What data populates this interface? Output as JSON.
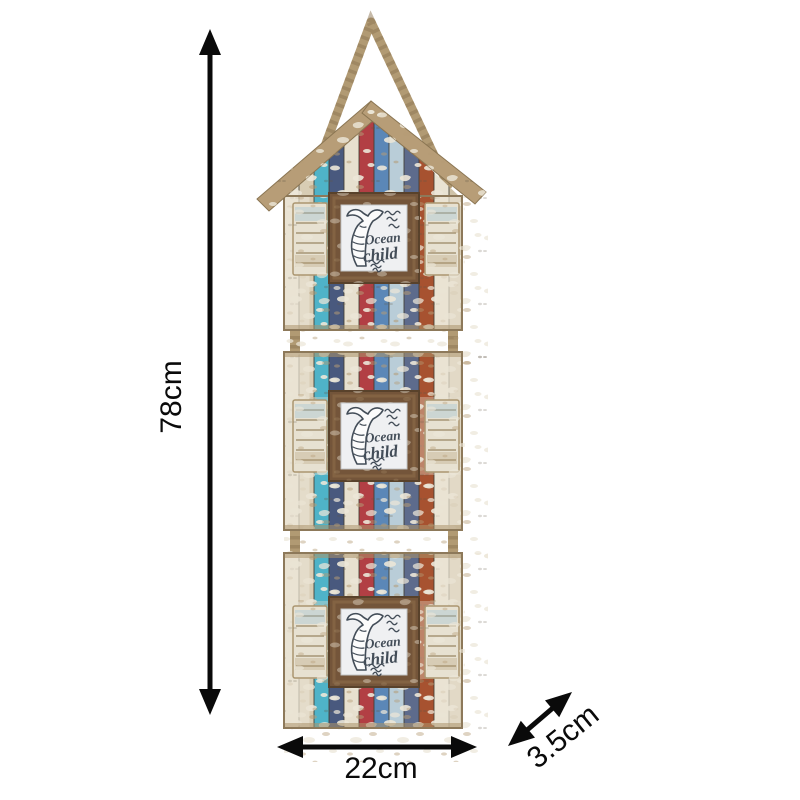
{
  "page": {
    "type": "product dimension diagram",
    "background": "#ffffff"
  },
  "product": {
    "name": "distressed wooden triple hanging photo frame with rope",
    "style": "beach hut",
    "frames_count": 3,
    "photo_text": {
      "line1": "Ocean",
      "line2": "child"
    },
    "colors": {
      "rope": "#b19a73",
      "rope_shadow": "#8d7553",
      "wood_tan": "#b79d77",
      "cream": "#e9e3d3",
      "teal": "#4fb3c8",
      "steel_blue": "#5b87b7",
      "navy": "#49597e",
      "slate": "#5d6b8c",
      "red": "#b23f44",
      "burnt_orange": "#a75230",
      "frame_wood_dark": "#74553a",
      "photo_background": "#eff0f2",
      "ink": "#434d58",
      "dimension_color": "#0a0a0a"
    }
  },
  "dimensions": {
    "height": {
      "label": "78cm",
      "value": 78,
      "unit": "cm"
    },
    "width": {
      "label": "22cm",
      "value": 22,
      "unit": "cm"
    },
    "depth": {
      "label": "3.5cm",
      "value": 3.5,
      "unit": "cm"
    }
  }
}
